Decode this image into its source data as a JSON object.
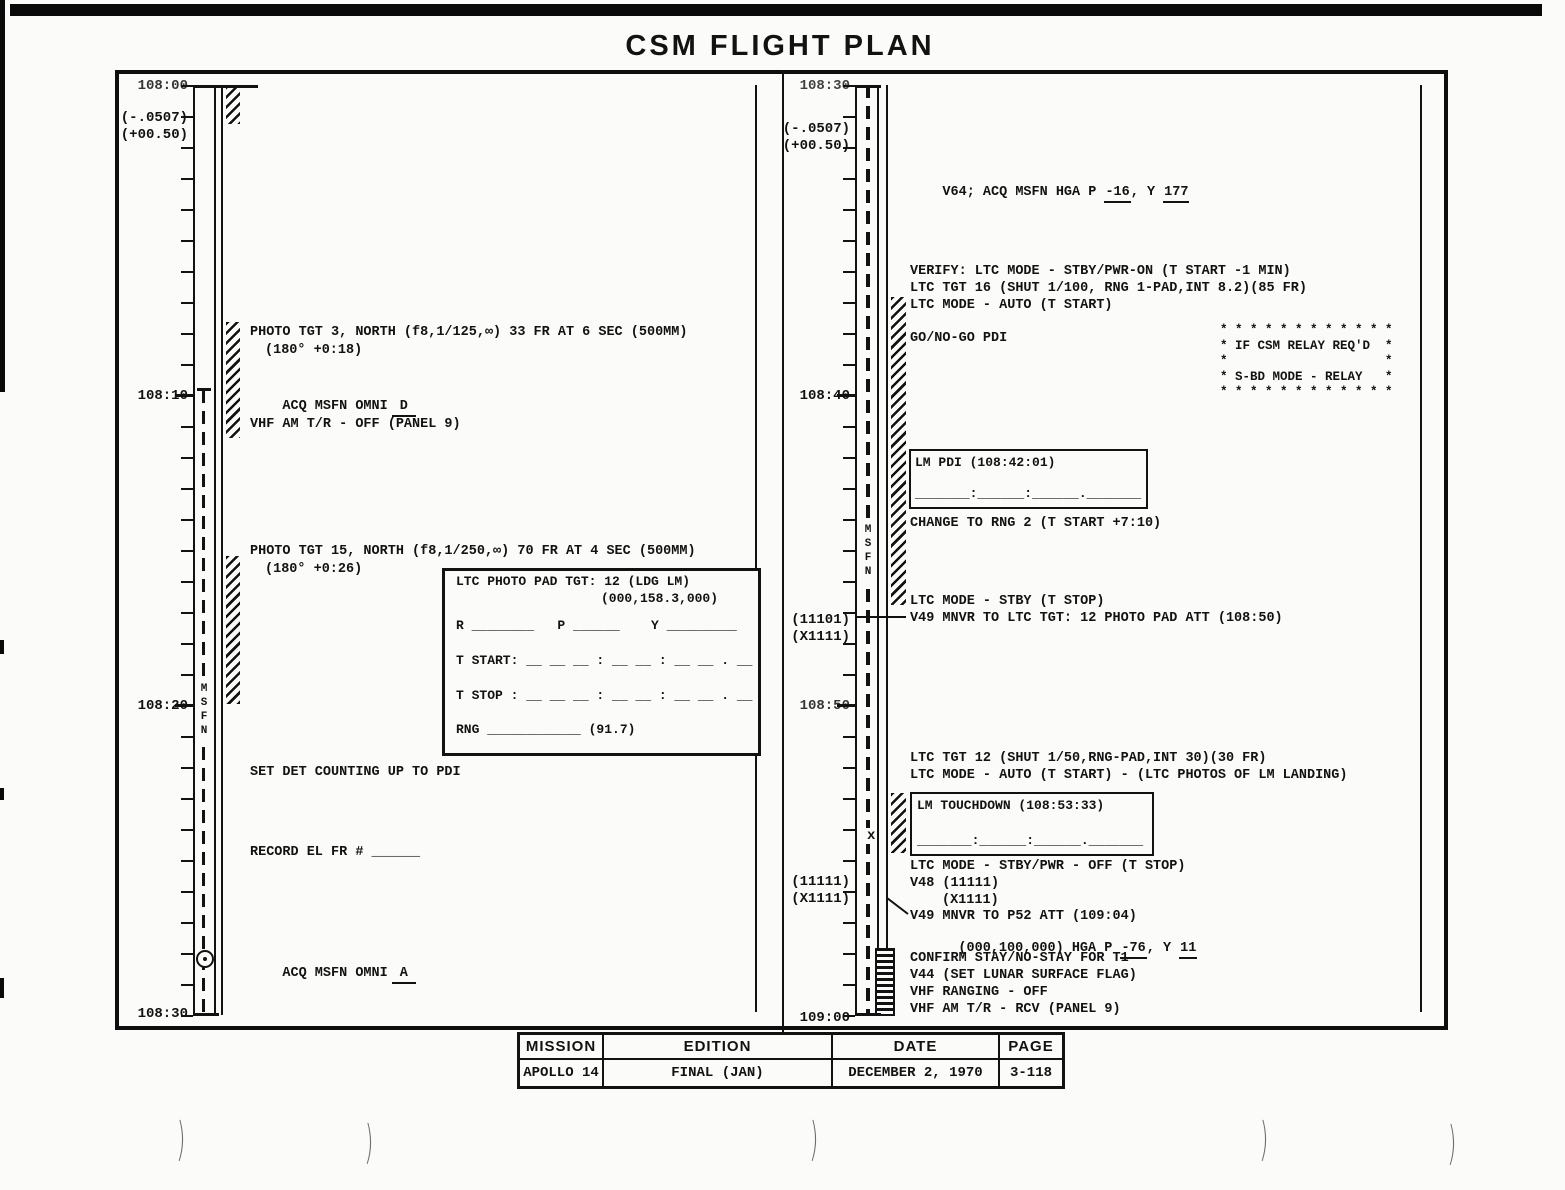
{
  "title": "CSM FLIGHT PLAN",
  "footer": {
    "headers": [
      "MISSION",
      "EDITION",
      "DATE",
      "PAGE"
    ],
    "values": [
      "APOLLO 14",
      "FINAL (JAN)",
      "DECEMBER 2, 1970",
      "3-118"
    ]
  },
  "artifacts": {
    "curve_mark": ")"
  },
  "left": {
    "time_108_00": "108:00",
    "rate1": "(-.0507)",
    "rate2": "(+00.50)",
    "time_108_10": "108:10",
    "time_108_20": "108:20",
    "time_108_30": "108:30",
    "msfn": "MSFN",
    "photo_tgt3_1": "PHOTO TGT 3, NORTH (f8,1/125,∞) 33 FR AT 6 SEC (500MM)",
    "photo_tgt3_2": "(180° +0:18)",
    "acq_d_label": "ACQ MSFN OMNI",
    "acq_d_value": "D",
    "vhf_off": "VHF AM T/R - OFF (PANEL 9)",
    "photo_tgt15_1": "PHOTO TGT 15, NORTH (f8,1/250,∞) 70 FR AT 4 SEC (500MM)",
    "photo_tgt15_2": "(180° +0:26)",
    "set_det": "SET DET COUNTING UP TO PDI",
    "record_el": "RECORD EL FR # ______",
    "acq_a_label": "ACQ MSFN OMNI",
    "acq_a_value": "A",
    "photo_pad": {
      "line1": "LTC PHOTO PAD TGT: 12 (LDG LM)",
      "line2": "(000,158.3,000)",
      "line3": "R ________   P ______    Y _________",
      "line4": "T START: __ __ __ : __ __ : __ __ . __",
      "line5": "T STOP : __ __ __ : __ __ : __ __ . __",
      "line6": "RNG ____________ (91.7)"
    }
  },
  "right": {
    "time_108_30": "108:30",
    "rate1": "(-.0507)",
    "rate2": "(+00.50)",
    "time_108_40": "108:40",
    "att1a": "(11101)",
    "att1b": "(X1111)",
    "time_108_50": "108:50",
    "att2a": "(11111)",
    "att2b": "(X1111)",
    "time_109_00": "109:00",
    "msfn": "MSFN",
    "x_marker": "x",
    "v64_pre": "V64; ACQ MSFN HGA P ",
    "v64_p": "-16",
    "v64_mid": ", Y ",
    "v64_y": "177",
    "verify1": "VERIFY: LTC MODE - STBY/PWR-ON (T START -1 MIN)",
    "verify2": "LTC TGT 16 (SHUT 1/100, RNG 1-PAD,INT 8.2)(85 FR)",
    "verify3": "LTC MODE - AUTO (T START)",
    "gonogo": "GO/NO-GO PDI",
    "relay1": "* * * * * * * * * * * *",
    "relay2": "* IF CSM RELAY REQ'D  *",
    "relay3": "*                     *",
    "relay4": "* S-BD MODE - RELAY   *",
    "relay5": "* * * * * * * * * * * *",
    "lm_pdi_title": "LM PDI (108:42:01)",
    "lm_pdi_blank": "_______:______:______._______",
    "change_rng": "CHANGE TO RNG 2 (T START +7:10)",
    "ltc_stby": "LTC MODE - STBY (T STOP)",
    "v49_ltc": "V49 MNVR TO LTC TGT: 12 PHOTO PAD ATT (108:50)",
    "ltc_tgt12_1": "LTC TGT 12 (SHUT 1/50,RNG-PAD,INT 30)(30 FR)",
    "ltc_tgt12_2": "LTC MODE - AUTO (T START) - (LTC PHOTOS OF LM LANDING)",
    "td_title": "LM TOUCHDOWN (108:53:33)",
    "td_blank": "_______:______:______._______",
    "ltc_off": "LTC MODE - STBY/PWR - OFF (T STOP)",
    "v48_1": "V48 (11111)",
    "v48_2": "(X1111)",
    "v49_p52": "V49 MNVR TO P52 ATT (109:04)",
    "p52_pre": "(000,100,000) HGA P ",
    "p52_p": "-76",
    "p52_mid": ", Y ",
    "p52_y": "11",
    "confirm": "CONFIRM STAY/NO-STAY FOR T1",
    "v44": "V44 (SET LUNAR SURFACE FLAG)",
    "vhf_ranging": "VHF RANGING - OFF",
    "vhf_rcv": "VHF AM T/R - RCV (PANEL 9)"
  }
}
